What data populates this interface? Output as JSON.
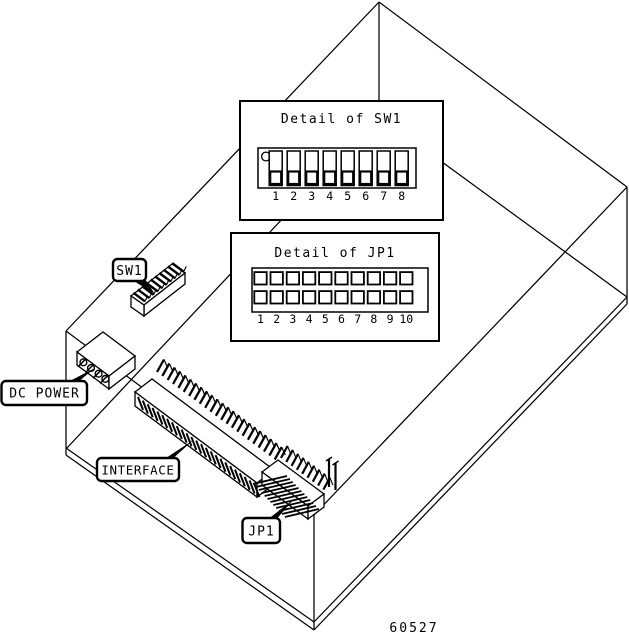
{
  "figure": {
    "number": "60527"
  },
  "colors": {
    "line": "#000000",
    "background": "#ffffff"
  },
  "detail_sw1": {
    "title": "Detail of SW1",
    "positions": [
      "1",
      "2",
      "3",
      "4",
      "5",
      "6",
      "7",
      "8"
    ],
    "switch_count": 8
  },
  "detail_jp1": {
    "title": "Detail of JP1",
    "positions": [
      "1",
      "2",
      "3",
      "4",
      "5",
      "6",
      "7",
      "8",
      "9",
      "10"
    ],
    "rows": 2,
    "columns": 10
  },
  "callouts": {
    "sw1": "SW1",
    "dc_power": "DC POWER",
    "interface": "INTERFACE",
    "jp1": "JP1"
  },
  "components": {
    "sw1_actuator_count": 10,
    "dc_power_pin_count": 4,
    "interface_pin_count": 23,
    "interface_front_hatch_count": 25,
    "jp1_pin_count": 9,
    "jp1_front_hatch_count": 12
  }
}
